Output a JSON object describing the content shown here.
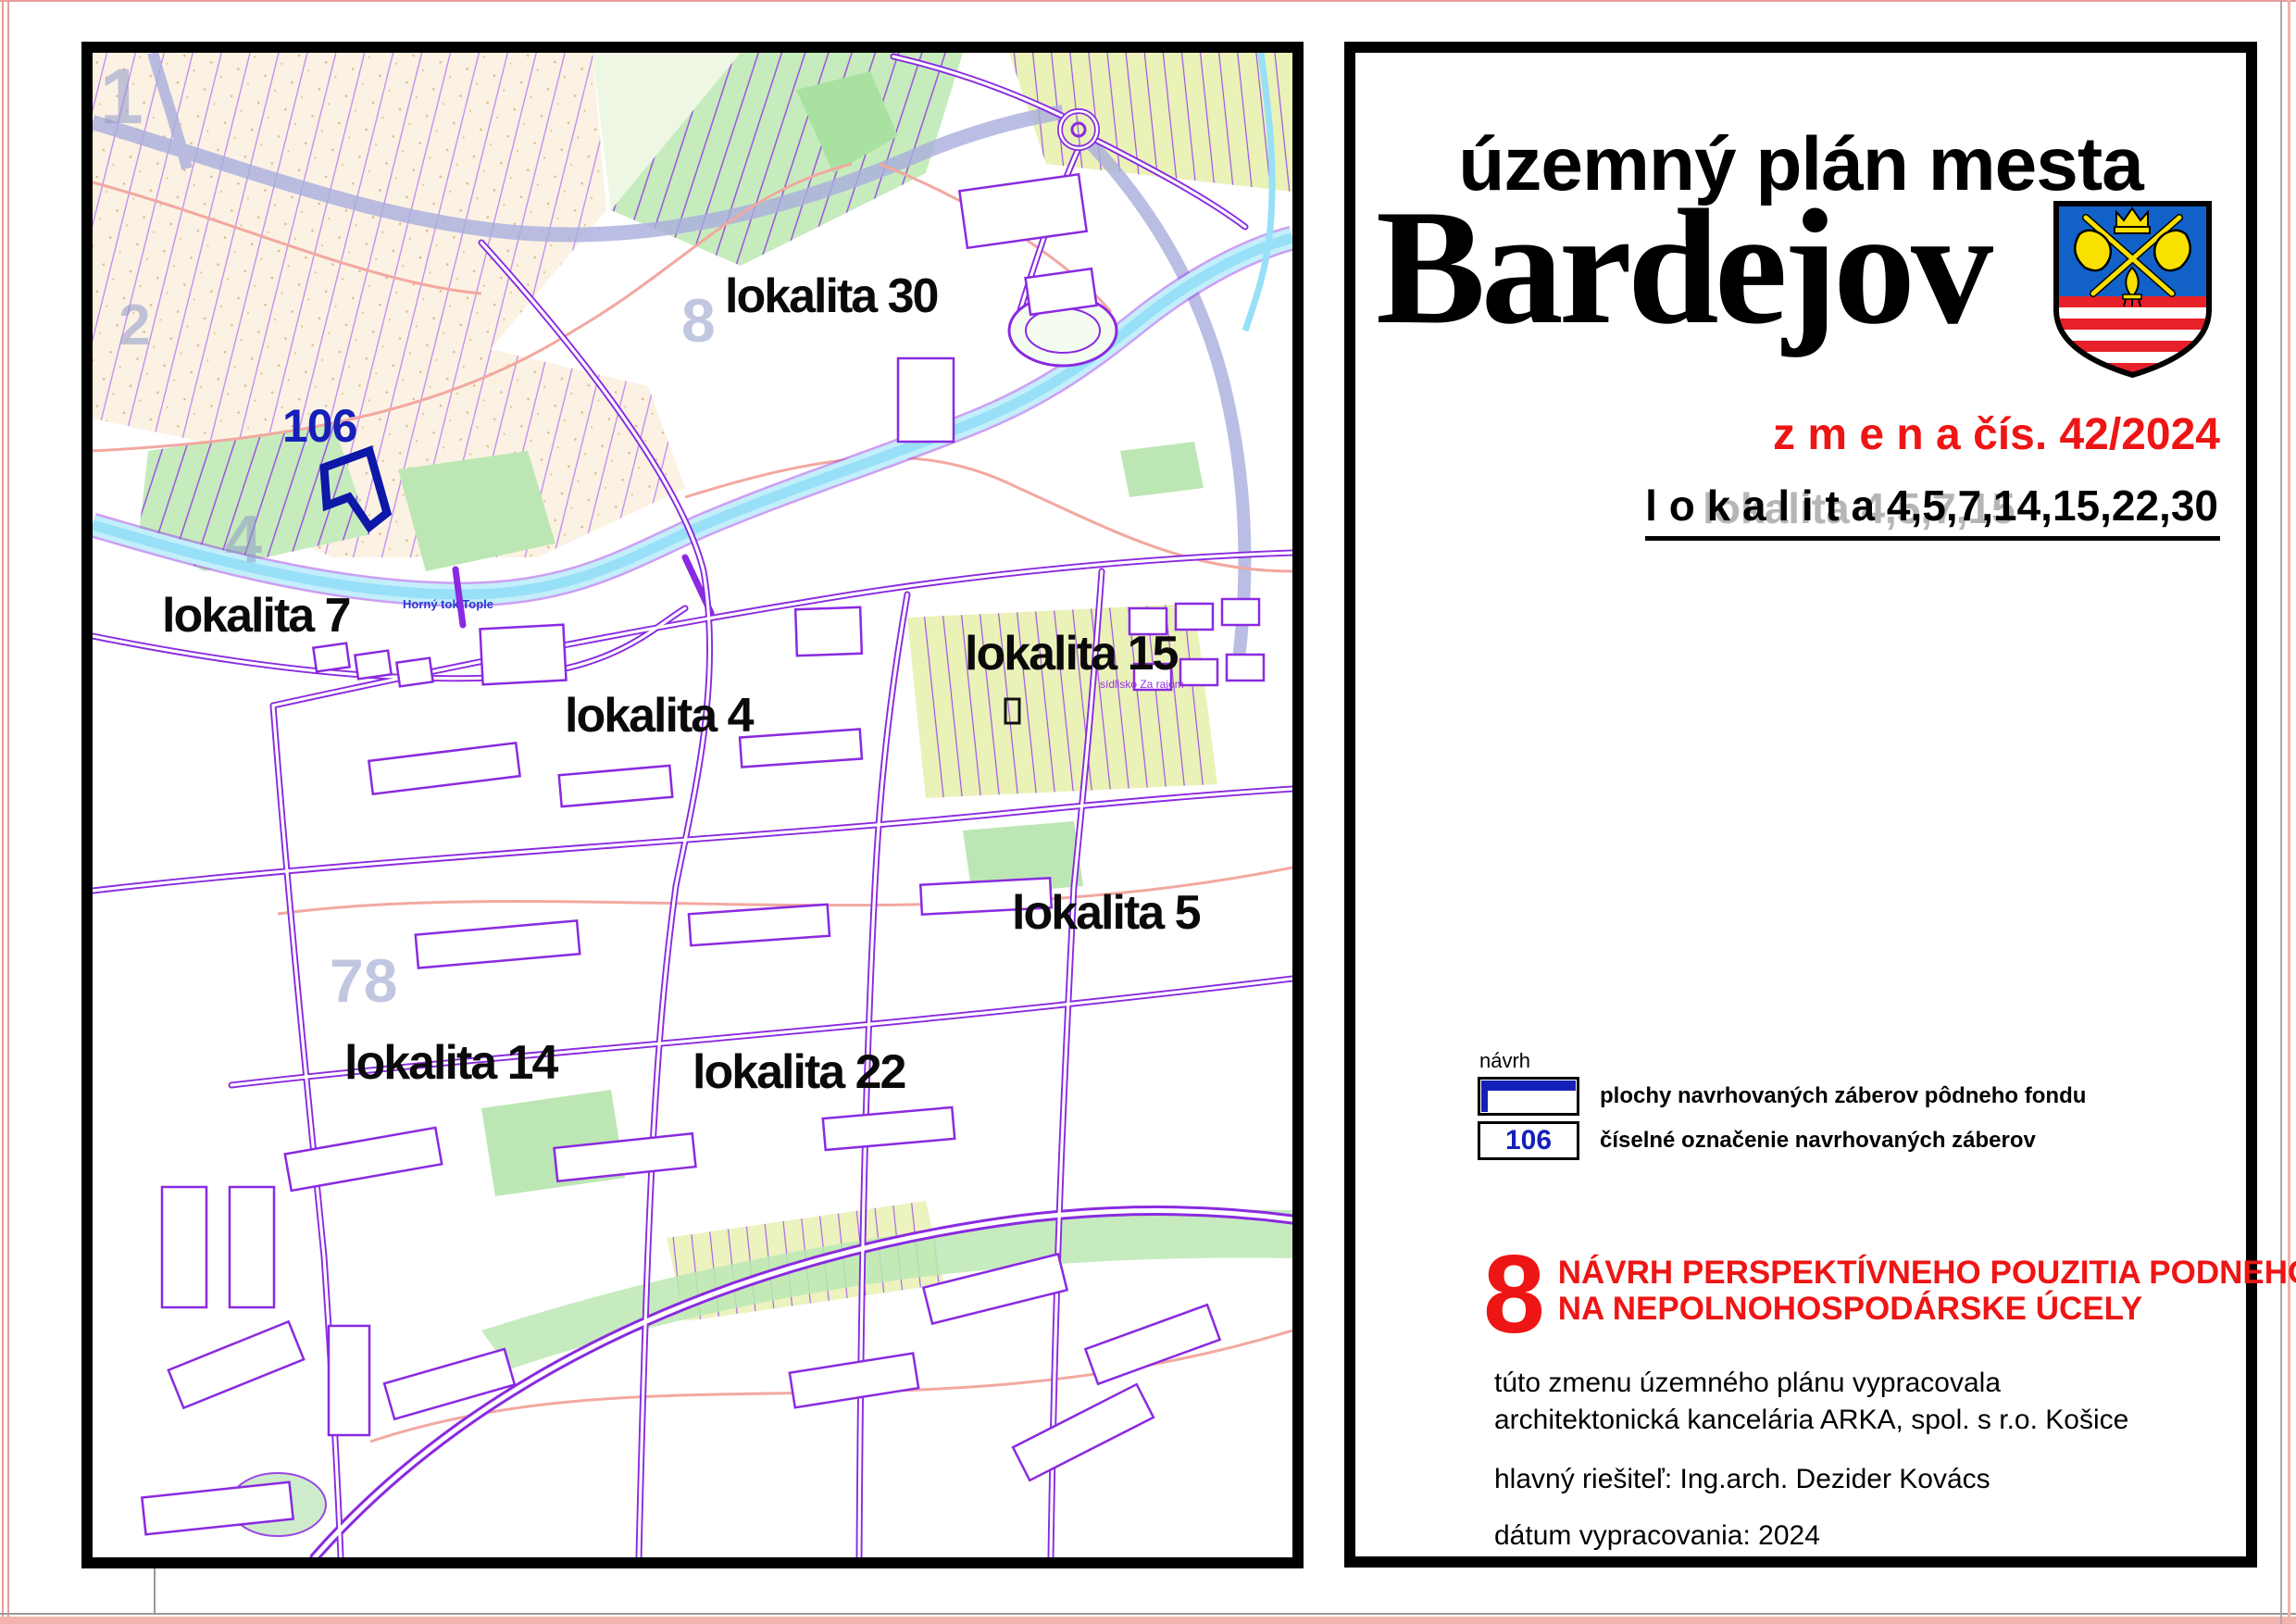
{
  "title_block": {
    "subtitle": "územný plán mesta",
    "city": "Bardejov",
    "change_line": "z m e n a  čís. 42/2024",
    "localities_line": "l o k a l i t a  4,5,7,14,15,22,30",
    "localities_ghost": "lokalita 4,5,7,15",
    "legend": {
      "heading": "návrh",
      "item1_label": "plochy navrhovaných záberov pôdneho fondu",
      "item2_symbol": "106",
      "item2_label": "číselné označenie navrhovaných záberov"
    },
    "sheet": {
      "number": "8",
      "line1": "NÁVRH PERSPEKTÍVNEHO POUZITIA PODNEHO FONDU",
      "line2": "NA NEPOLNOHOSPODÁRSKE ÚCELY",
      "scale": "M 1:5000"
    },
    "credits": {
      "line1": "túto zmenu územného plánu vypracovala",
      "line2": "architektonická kancelária ARKA, spol. s r.o. Košice",
      "line3": "hlavný riešiteľ: Ing.arch. Dezider Kovács",
      "line4": "dátum vypracovania: 2024"
    }
  },
  "map": {
    "labels": {
      "l30": "lokalita 30",
      "l7": "lokalita 7",
      "l4": "lokalita 4",
      "l15": "lokalita 15",
      "l5": "lokalita 5",
      "l14": "lokalita 14",
      "l22": "lokalita 22"
    },
    "area_number": "106",
    "river_name": "Horný tok Tople",
    "district_name": "sídlisko Za rajom",
    "sheet_numbers": {
      "top_left": "1",
      "left": "2",
      "center": "8",
      "bottom_left": "78",
      "river": "4"
    }
  },
  "colors": {
    "accent_red": "#ee1515",
    "label_blue": "#1520b8",
    "map_purple": "#8a2ae0",
    "river_cyan": "#97e0f7",
    "shield_blue": "#1261c8",
    "shield_red": "#e8202a",
    "shield_yellow": "#f8e000"
  }
}
